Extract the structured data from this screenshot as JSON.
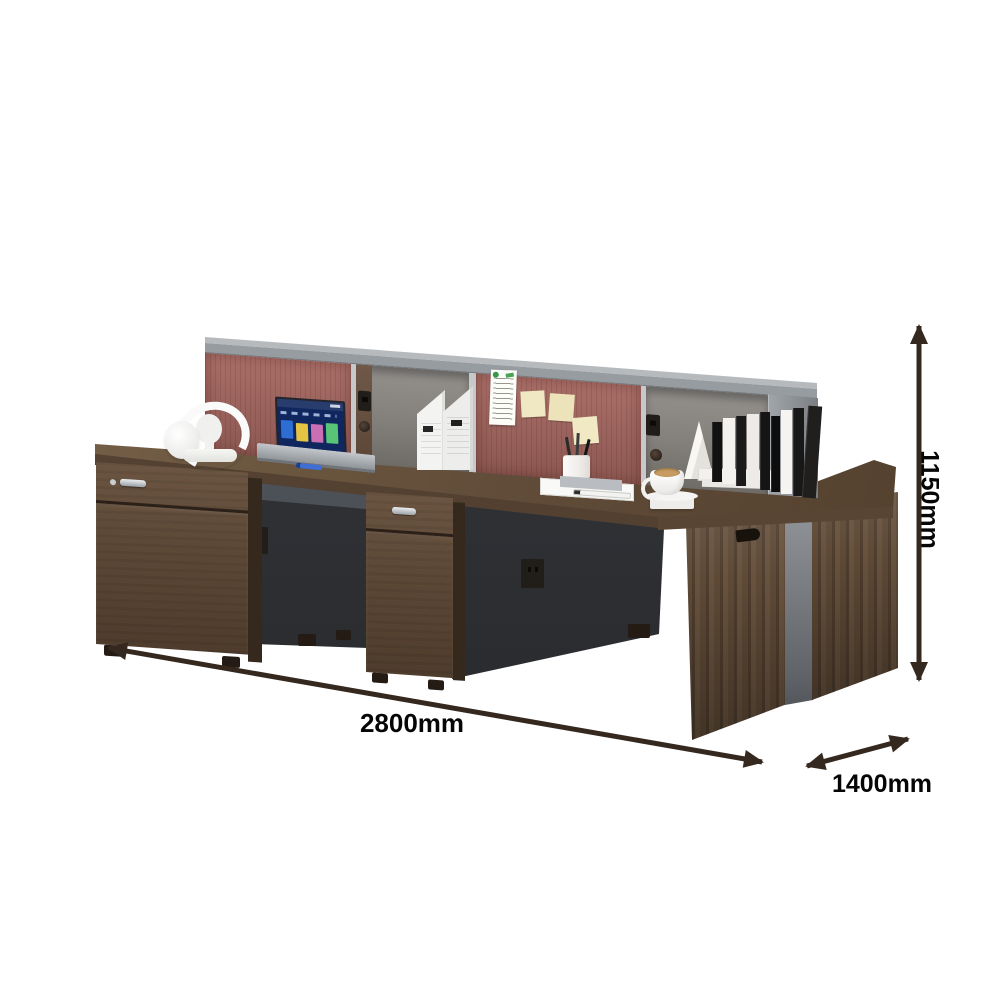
{
  "dimension_labels": {
    "width": "2800mm",
    "depth": "1400mm",
    "height": "1150mm"
  },
  "palette": {
    "background": "#ffffff",
    "desk_wood": "#5e4a37",
    "desk_wood_top": "#6b563f",
    "pedestal_charcoal": "#2e3034",
    "pinboard_red": "#a4665f",
    "hutch_gray": "#9aa0a5",
    "divider_gray": "#7a7e82",
    "arrow_color": "#35281f",
    "label_color": "#060606"
  },
  "scene_objects": [
    "office-workstation-desk",
    "overhead-hutch-with-red-pinboards",
    "white-headphones",
    "laptop",
    "document-organizers",
    "pinned-note",
    "sticky-notes",
    "pen-holder",
    "notebook-and-pen",
    "coffee-cup",
    "books",
    "drawer-pedestals",
    "power-outlets"
  ]
}
